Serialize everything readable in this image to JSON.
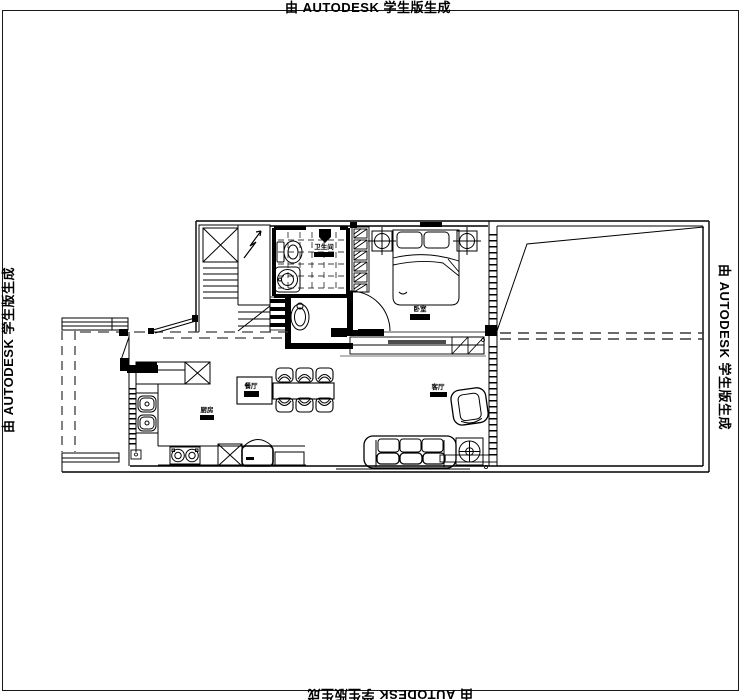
{
  "watermarks": {
    "top": "由 AUTODESK 学生版生成",
    "bottom": "由 AUTODESK 学生版生成",
    "left": "由 AUTODESK 学生版生成",
    "right": "由 AUTODESK 学生版生成"
  },
  "rooms": {
    "bathroom": {
      "label": "卫生间"
    },
    "bedroom": {
      "label": "卧室"
    },
    "dining": {
      "label": "餐厅"
    },
    "kitchen": {
      "label": "厨房"
    },
    "living": {
      "label": "客厅"
    }
  },
  "colors": {
    "line": "#000000",
    "background": "#ffffff",
    "dashed_guide": "#3a3a3a",
    "window_bar": "#4d4d4d"
  }
}
